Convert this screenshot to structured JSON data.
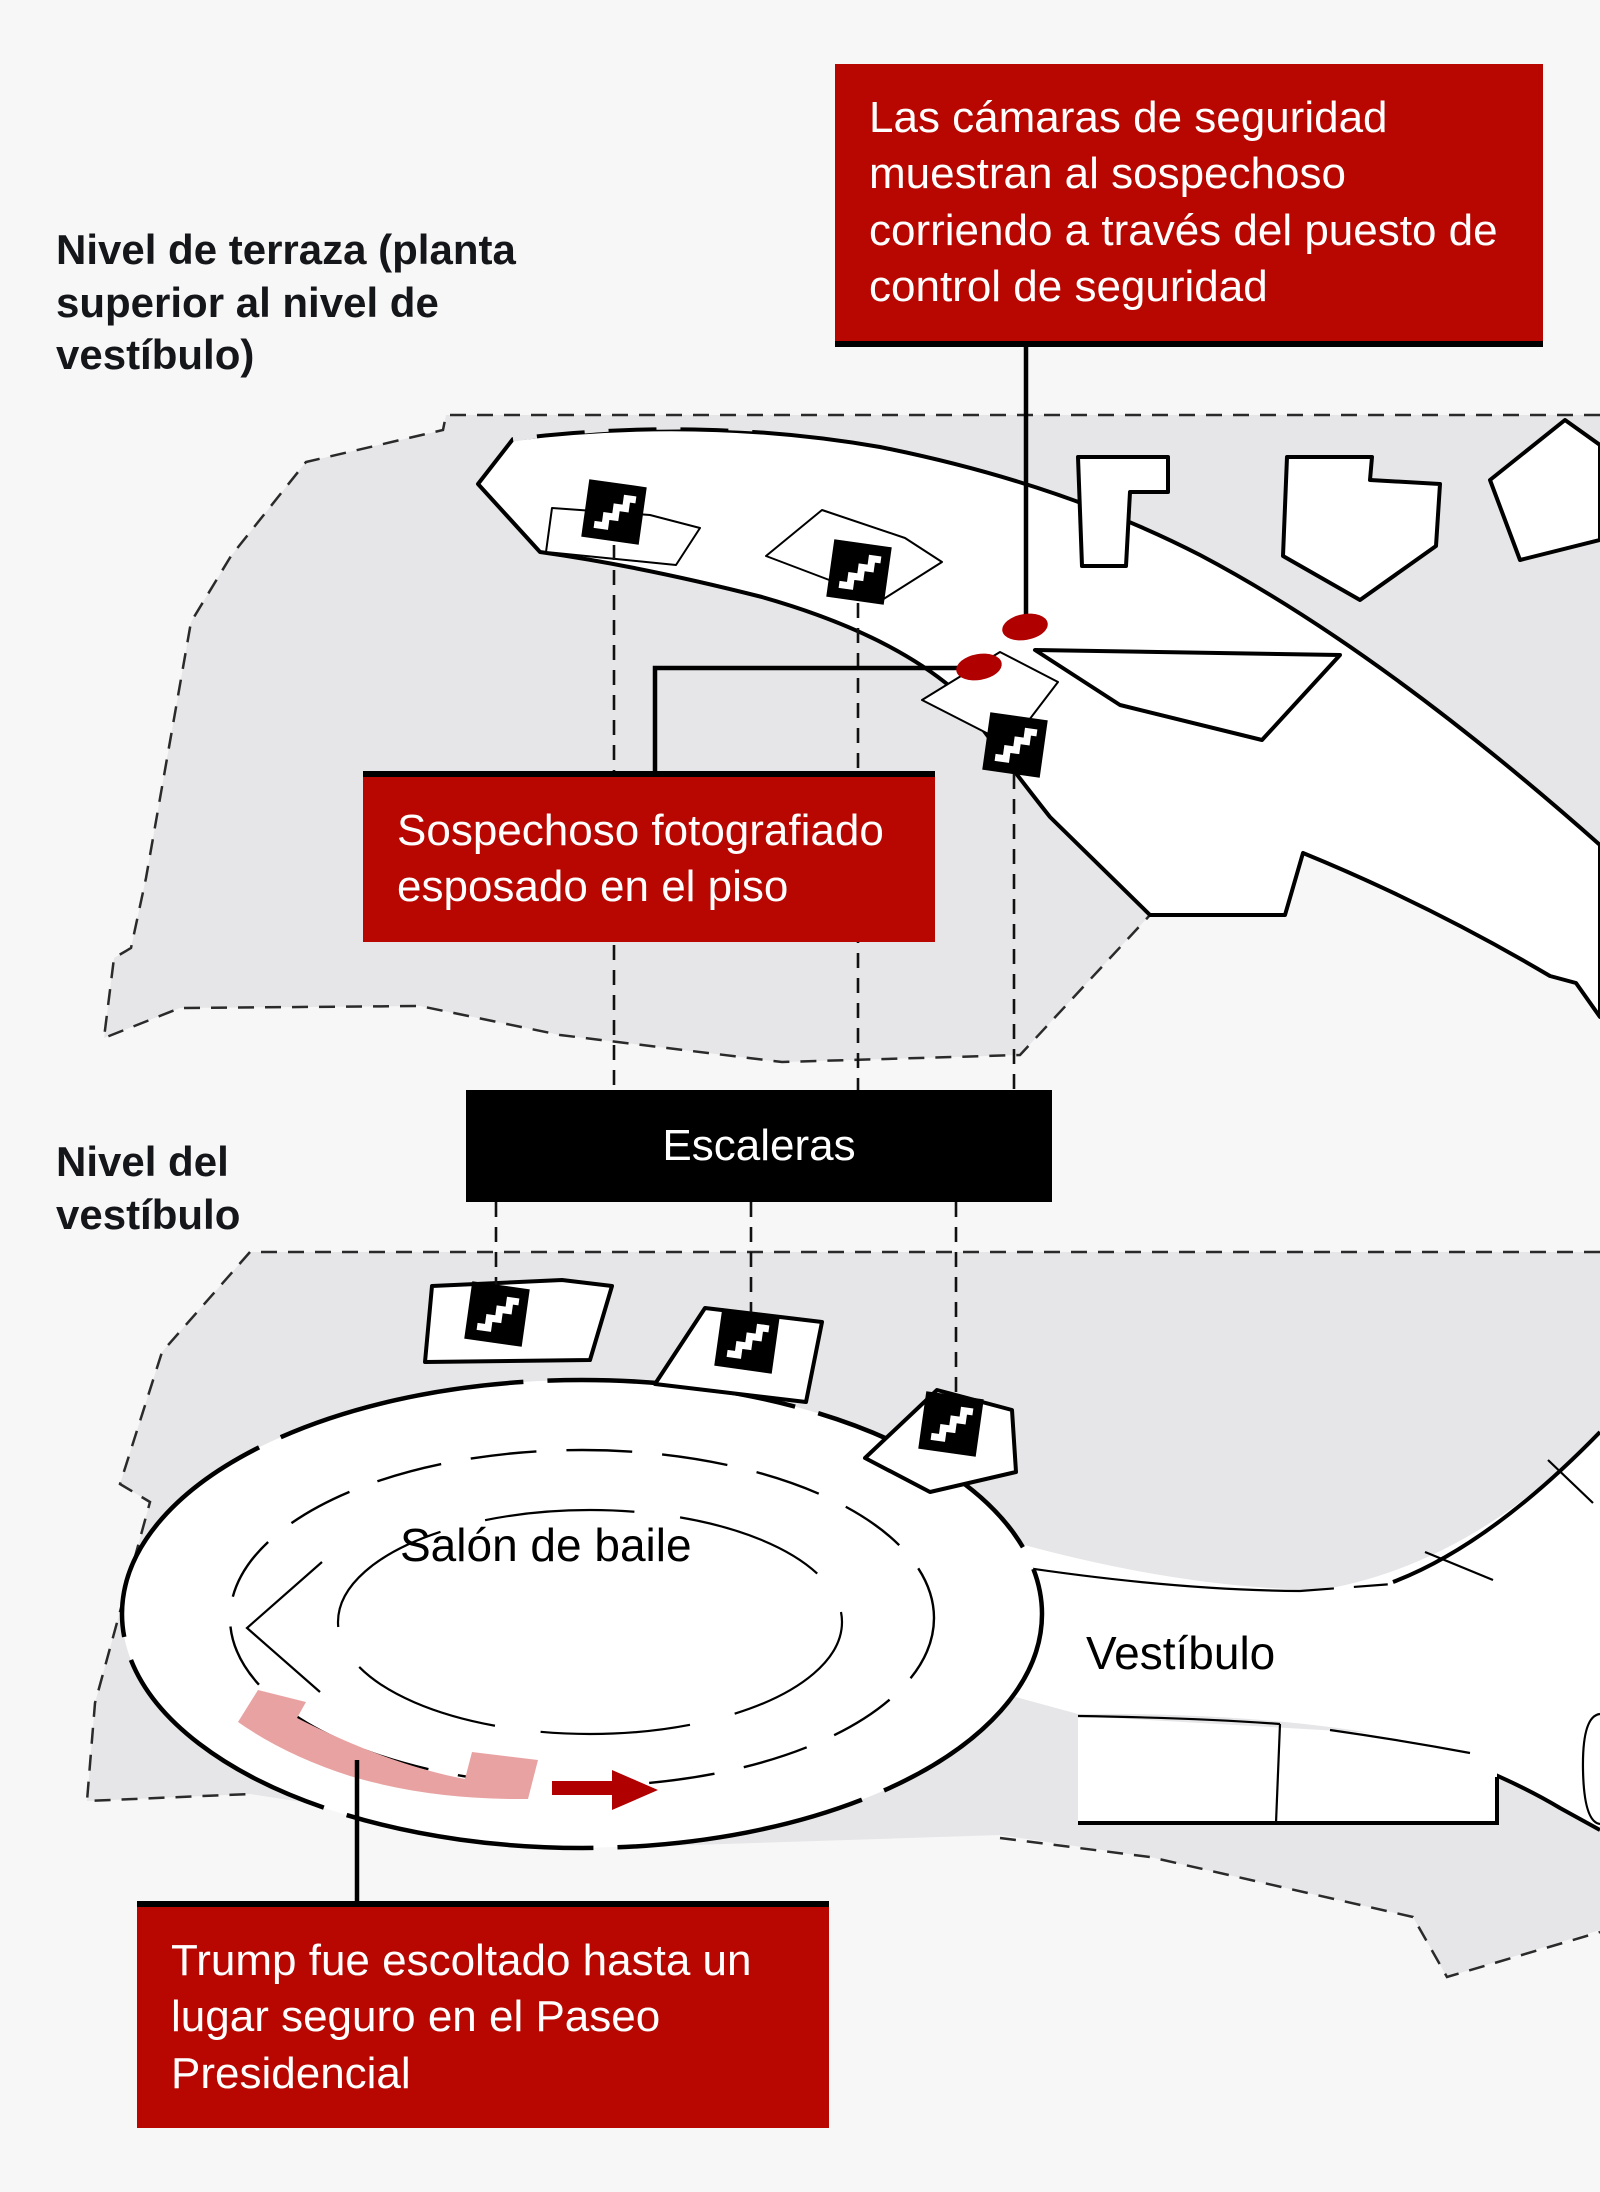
{
  "figure": {
    "terrace": {
      "title": "Nivel de terraza (planta superior al nivel de vestíbulo)"
    },
    "lobby": {
      "title": "Nivel del vestíbulo",
      "ballroom_label": "Salón de baile",
      "corridor_label": "Vestíbulo"
    },
    "stairs_bar_label": "Escaleras",
    "callouts": {
      "security": "Las cámaras de seguridad muestran al sospechoso corriendo a través del puesto de control de seguridad",
      "suspect": "Sospechoso fotografiado esposado en el piso",
      "escort": "Trump fue escoltado hasta un lugar seguro en el Paseo Presidencial"
    },
    "markers": {
      "suspect_location_dots": 2,
      "stairs_icons": 6,
      "escort_arrow_direction": "right"
    }
  },
  "colors": {
    "callout_red": "#b80600",
    "marker_red": "#b00000",
    "path_pink": "#e9a2a2",
    "area_gray": "#e6e6e8",
    "background": "#f7f7f8"
  }
}
